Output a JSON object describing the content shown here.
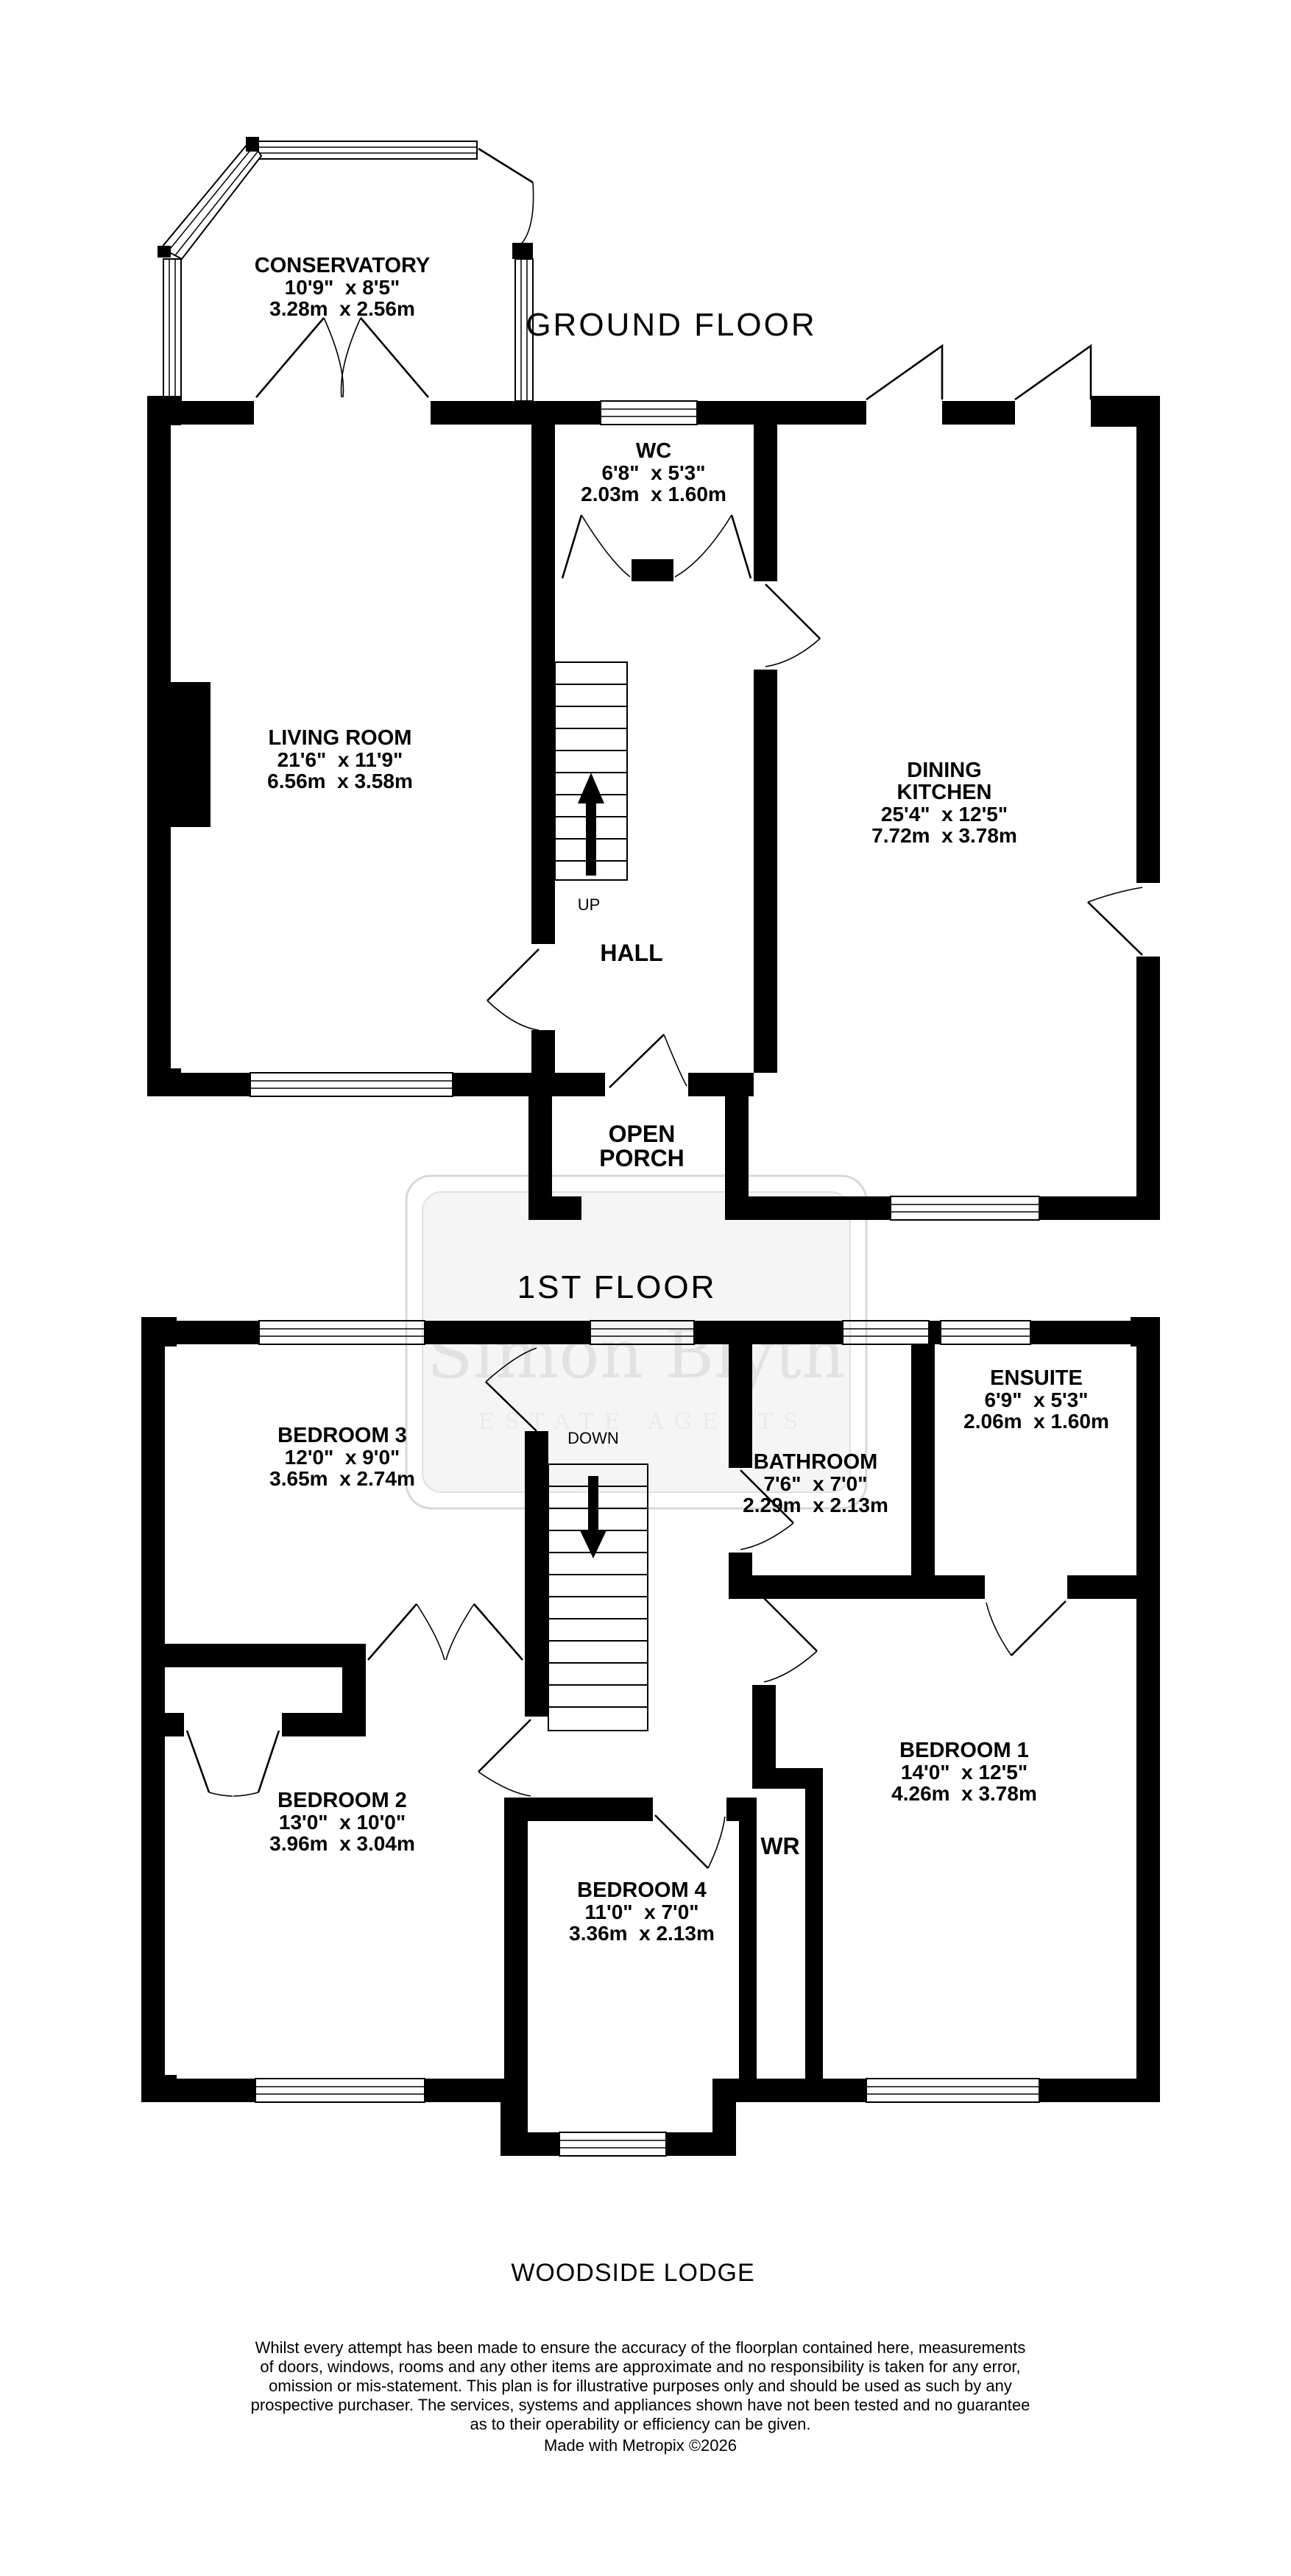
{
  "floors": {
    "ground": {
      "label": "GROUND FLOOR",
      "rooms": {
        "conservatory": {
          "name": "CONSERVATORY",
          "imperial": "10'9\"  x 8'5\"",
          "metric": "3.28m  x 2.56m"
        },
        "wc": {
          "name": "WC",
          "imperial": "6'8\"  x 5'3\"",
          "metric": "2.03m  x 1.60m"
        },
        "living_room": {
          "name": "LIVING ROOM",
          "imperial": "21'6\"  x 11'9\"",
          "metric": "6.56m  x 3.58m"
        },
        "dining_kitchen": {
          "name_line1": "DINING",
          "name_line2": "KITCHEN",
          "imperial": "25'4\"  x 12'5\"",
          "metric": "7.72m  x 3.78m"
        },
        "hall": {
          "name": "HALL"
        },
        "open_porch": {
          "name_line1": "OPEN",
          "name_line2": "PORCH"
        }
      },
      "stairs": {
        "direction": "UP"
      }
    },
    "first": {
      "label": "1ST FLOOR",
      "rooms": {
        "bedroom3": {
          "name": "BEDROOM 3",
          "imperial": "12'0\"  x 9'0\"",
          "metric": "3.65m  x 2.74m"
        },
        "bathroom": {
          "name": "BATHROOM",
          "imperial": "7'6\"  x 7'0\"",
          "metric": "2.29m  x 2.13m"
        },
        "ensuite": {
          "name": "ENSUITE",
          "imperial": "6'9\"  x 5'3\"",
          "metric": "2.06m  x 1.60m"
        },
        "bedroom2": {
          "name": "BEDROOM 2",
          "imperial": "13'0\"  x 10'0\"",
          "metric": "3.96m  x 3.04m"
        },
        "bedroom4": {
          "name": "BEDROOM 4",
          "imperial": "11'0\"  x 7'0\"",
          "metric": "3.36m  x 2.13m"
        },
        "bedroom1": {
          "name": "BEDROOM 1",
          "imperial": "14'0\"  x 12'5\"",
          "metric": "4.26m  x 3.78m"
        },
        "wr": {
          "name": "WR"
        }
      },
      "stairs": {
        "direction": "DOWN"
      }
    }
  },
  "watermark": {
    "line1": "Simon Blyth",
    "line2": "ESTATE AGENTS"
  },
  "footer": {
    "title": "WOODSIDE LODGE",
    "disclaimer": {
      "lines": [
        "Whilst every attempt has been made to ensure the accuracy of the floorplan contained here, measurements",
        "of doors, windows, rooms and any other items are approximate and no responsibility is taken for any error,",
        "omission or mis-statement. This plan is for illustrative purposes only and should be used as such by any",
        "prospective purchaser. The services, systems and appliances shown have not been tested and no guarantee",
        "as to their operability or efficiency can be given."
      ]
    },
    "credit": "Made with Metropix ©2026"
  }
}
